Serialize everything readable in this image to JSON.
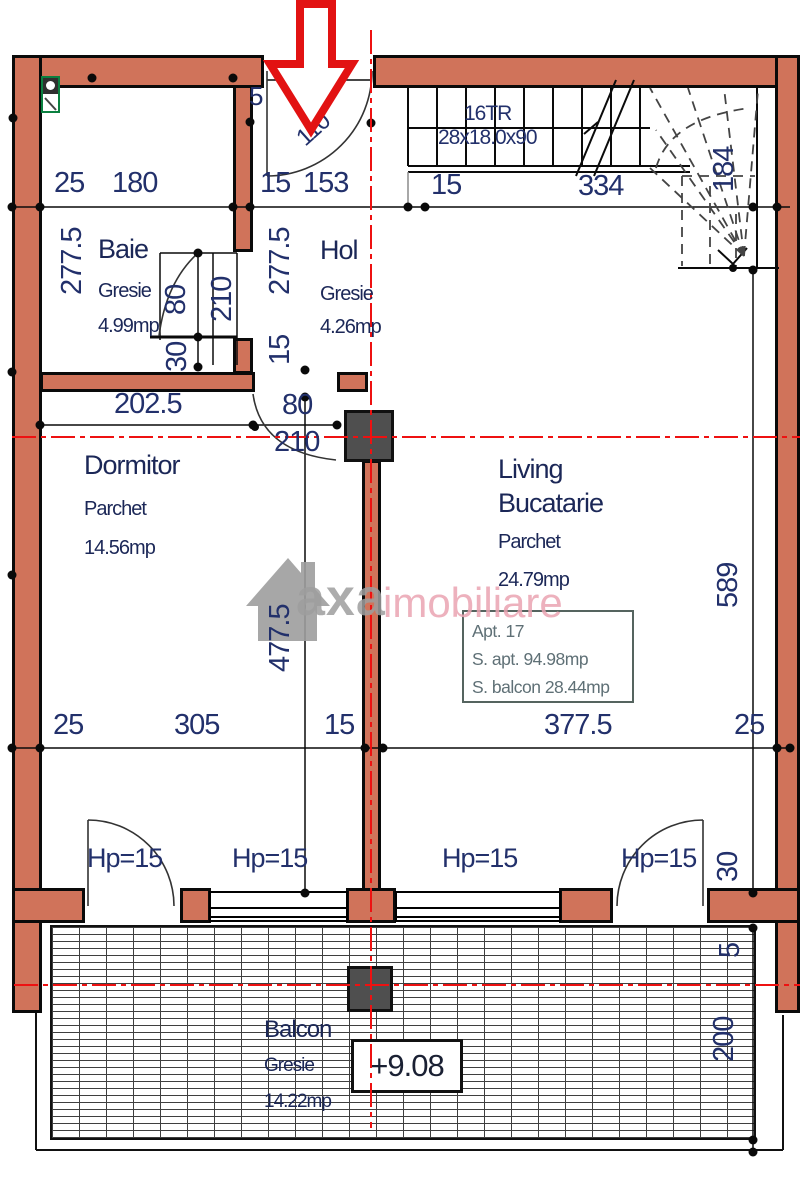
{
  "rooms": {
    "baie": {
      "name": "Baie",
      "finish": "Gresie",
      "area": "4.99mp"
    },
    "hol": {
      "name": "Hol",
      "finish": "Gresie",
      "area": "4.26mp"
    },
    "dormitor": {
      "name": "Dormitor",
      "finish": "Parchet",
      "area": "14.56mp"
    },
    "living": {
      "name": "Living",
      "name2": "Bucatarie",
      "finish": "Parchet",
      "area": "24.79mp"
    },
    "balcon": {
      "name": "Balcon",
      "finish": "Gresie",
      "area": "14.22mp"
    }
  },
  "stairs": {
    "count_label": "16TR",
    "step_size": "28x18.0x90"
  },
  "apartment_info": {
    "line1": "Apt. 17",
    "line2": "S. apt. 94.98mp",
    "line3": "S. balcon 28.44mp"
  },
  "elevation_label": "+9.08",
  "parapet": [
    "Hp=15",
    "Hp=15",
    "Hp=15",
    "Hp=15"
  ],
  "dimensions": {
    "top": [
      "25",
      "180",
      "15",
      "153",
      "15",
      "334"
    ],
    "bottom": [
      "25",
      "305",
      "15",
      "377.5",
      "25"
    ],
    "baie_height": "277.5",
    "hol_height": "277.5",
    "hol_wall": "15",
    "dormitor_height": "477.5",
    "stair_width": "184",
    "living_height": "589",
    "parapet_thickness": "30",
    "balcony_gap": "5",
    "balcony_depth": "200",
    "baie_door_width": "80",
    "baie_door_height": "210",
    "baie_wall": "30",
    "dormitor_top": "202.5",
    "dormitor_door_width": "80",
    "dormitor_door_height": "210",
    "entrance_side": "5",
    "entrance_door": "110"
  },
  "watermark": {
    "brand": "axa",
    "brand2": "imobiliare"
  },
  "colors": {
    "wall": "#d0735a",
    "centerline": "#ee1111",
    "arrow": "#e21212",
    "dim_text": "#22306b",
    "info_text": "#5f7076",
    "watermark_pink": "#eaa4b2",
    "watermark_gray": "#9e9e9e",
    "column": "#4f4f4f"
  }
}
